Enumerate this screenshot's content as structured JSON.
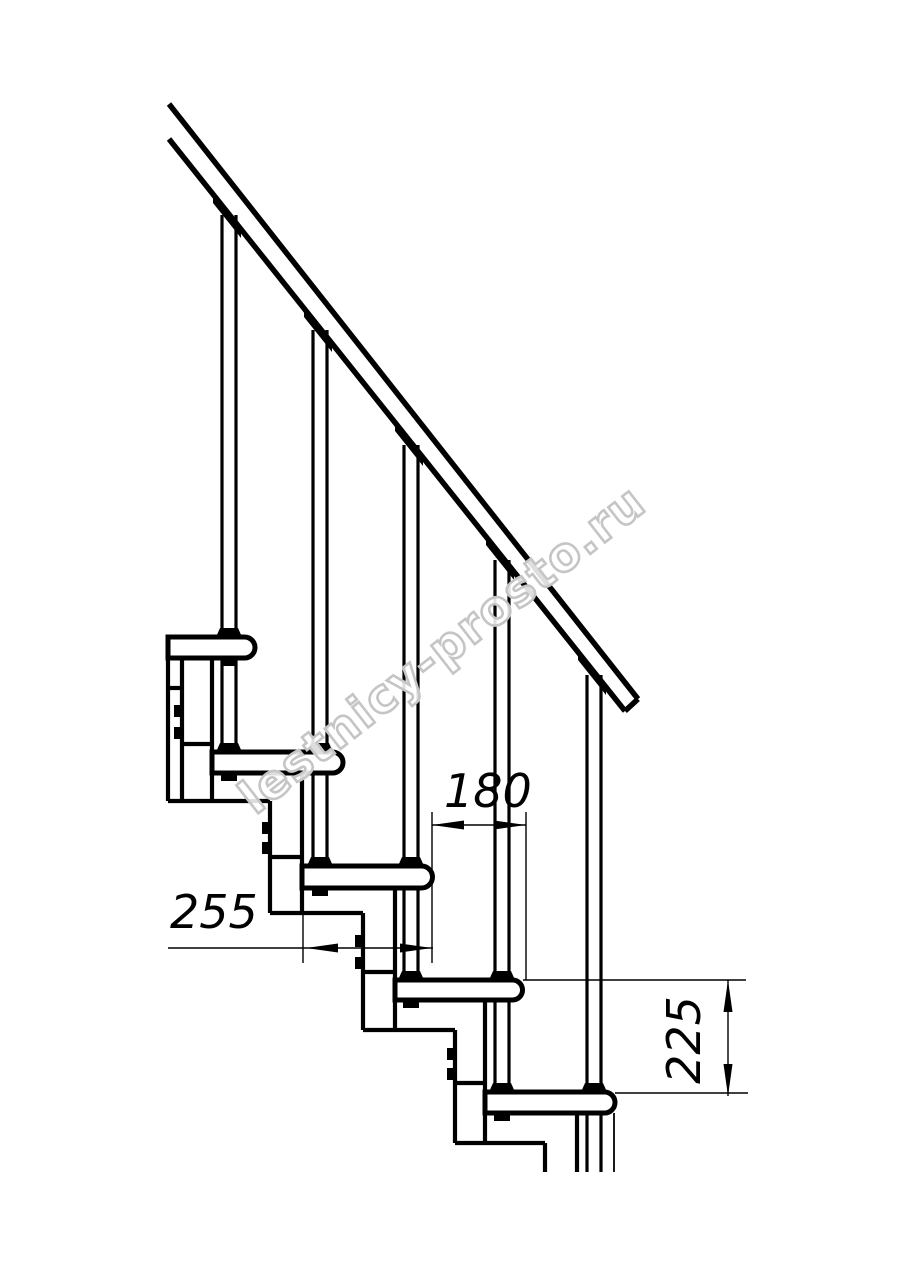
{
  "drawing": {
    "description": "staircase-side-view-technical-drawing",
    "line_color": "#000000",
    "background_color": "#ffffff",
    "annotations": {
      "dim_tread_depth": {
        "label": "255"
      },
      "dim_going": {
        "label": "180"
      },
      "dim_rise": {
        "label": "225"
      }
    },
    "watermark": {
      "text": "lestnicy-prosto.ru",
      "color": "#c5c5c5"
    }
  }
}
